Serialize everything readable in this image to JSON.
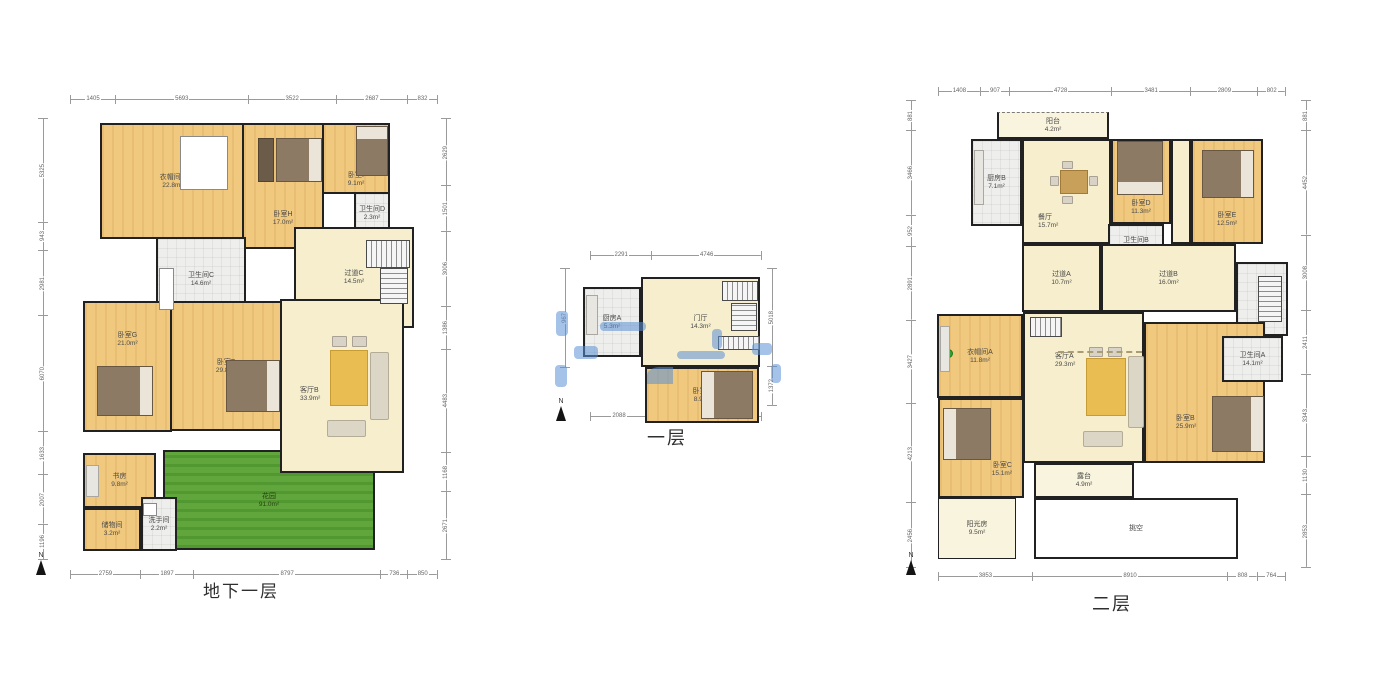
{
  "colors": {
    "wall": "#212121",
    "wood_floor": "#f0c87e",
    "parquet": "#f6eecd",
    "tile": "#eeeeec",
    "garden_green": "#57a133",
    "annotation_blue": "#5b8fd6"
  },
  "plans": [
    {
      "title": "地下一层",
      "compass": "N",
      "rooms": [
        {
          "name": "衣帽间B",
          "area": "22.8m²"
        },
        {
          "name": "卧室H",
          "area": "17.0m²"
        },
        {
          "name": "卧室I",
          "area": "9.1m²"
        },
        {
          "name": "卫生间D",
          "area": "2.3m²"
        },
        {
          "name": "卫生间C",
          "area": "14.6m²"
        },
        {
          "name": "过道C",
          "area": "14.5m²"
        },
        {
          "name": "卧室G",
          "area": "21.0m²"
        },
        {
          "name": "卧室F",
          "area": "29.8m²"
        },
        {
          "name": "客厅B",
          "area": "33.9m²"
        },
        {
          "name": "书房",
          "area": "9.8m²"
        },
        {
          "name": "储物间",
          "area": "3.2m²"
        },
        {
          "name": "洗手间",
          "area": "2.2m²"
        },
        {
          "name": "花园",
          "area": "91.0m²"
        }
      ],
      "dims_top": [
        "1405",
        "5693",
        "3522",
        "2687",
        "832"
      ],
      "dims_bottom": [
        "2759",
        "1897",
        "8797",
        "736",
        "850"
      ],
      "dims_left": [
        "5325",
        "943",
        "2981",
        "6070",
        "1633",
        "2007",
        "1196"
      ],
      "dims_right": [
        "2629",
        "1501",
        "3006",
        "1386",
        "4483",
        "1168",
        "2671"
      ]
    },
    {
      "title": "一层",
      "compass": "N",
      "rooms": [
        {
          "name": "厨房A",
          "area": "5.3m²"
        },
        {
          "name": "门厅",
          "area": "14.3m²"
        },
        {
          "name": "卧室A",
          "area": "8.9m²"
        }
      ],
      "dims_top": [
        "2291",
        "4746"
      ],
      "dims_bottom": [
        "2088",
        "5008"
      ],
      "dims_left": [
        "967"
      ],
      "dims_right": [
        "5018",
        "1372"
      ]
    },
    {
      "title": "二层",
      "compass": "N",
      "rooms": [
        {
          "name": "阳台",
          "area": "4.2m²"
        },
        {
          "name": "厨房B",
          "area": "7.1m²"
        },
        {
          "name": "餐厅",
          "area": "15.7m²"
        },
        {
          "name": "卧室D",
          "area": "11.3m²"
        },
        {
          "name": "卧室E",
          "area": "12.5m²"
        },
        {
          "name": "卫生间B",
          "area": "4.2m²"
        },
        {
          "name": "过道A",
          "area": "10.7m²"
        },
        {
          "name": "过道B",
          "area": "16.0m²"
        },
        {
          "name": "衣帽间A",
          "area": "11.8m²"
        },
        {
          "name": "客厅A",
          "area": "29.3m²"
        },
        {
          "name": "卫生间A",
          "area": "14.1m²"
        },
        {
          "name": "卧室B",
          "area": "25.9m²"
        },
        {
          "name": "卧室C",
          "area": "15.1m²"
        },
        {
          "name": "露台",
          "area": "4.9m²"
        },
        {
          "name": "阳光房",
          "area": "9.5m²"
        },
        {
          "name": "挑空",
          "area": ""
        }
      ],
      "dims_top": [
        "1408",
        "907",
        "4728",
        "3481",
        "2809",
        "802"
      ],
      "dims_bottom": [
        "3853",
        "8910",
        "808",
        "764"
      ],
      "dims_left": [
        "881",
        "3466",
        "952",
        "2891",
        "3427",
        "4213",
        "2456"
      ],
      "dims_right": [
        "881",
        "4452",
        "3008",
        "2411",
        "3343",
        "1130",
        "2853"
      ]
    }
  ]
}
